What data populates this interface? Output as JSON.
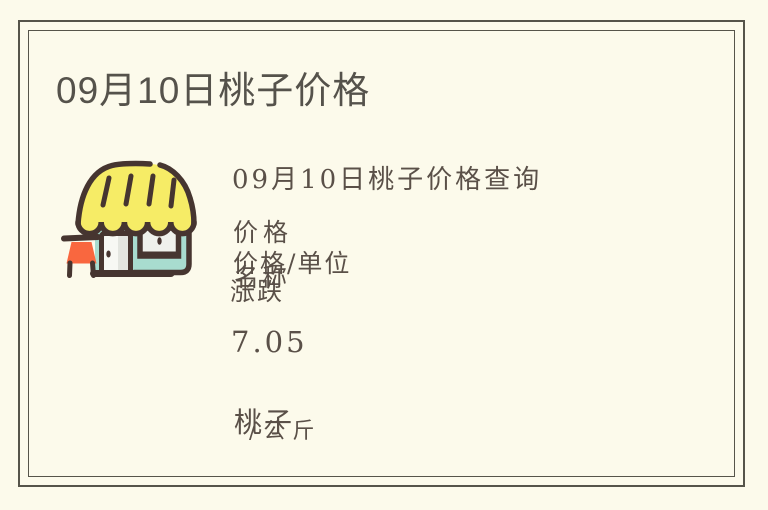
{
  "theme": {
    "background": "#FCFAEB",
    "frame_border": "#56544A",
    "title_color": "#55524B",
    "text_color": "#5A5048"
  },
  "title": "09月10日桃子价格",
  "article": {
    "heading": "09月10日桃子价格查询",
    "price_label": "价格",
    "price_unit_label": "价格/单位",
    "name_label": "名称",
    "change_label": "涨跌",
    "price_value": "7.05",
    "item_name": "桃子",
    "unit": "/公斤"
  },
  "icon": {
    "name": "storefront",
    "awning_color": "#F6EC66",
    "wall_color": "#A8DCCF",
    "outline_color": "#463530",
    "sign_color": "#F9673F",
    "door_color": "#F7F8F4",
    "window_color": "#EFF1EC"
  }
}
